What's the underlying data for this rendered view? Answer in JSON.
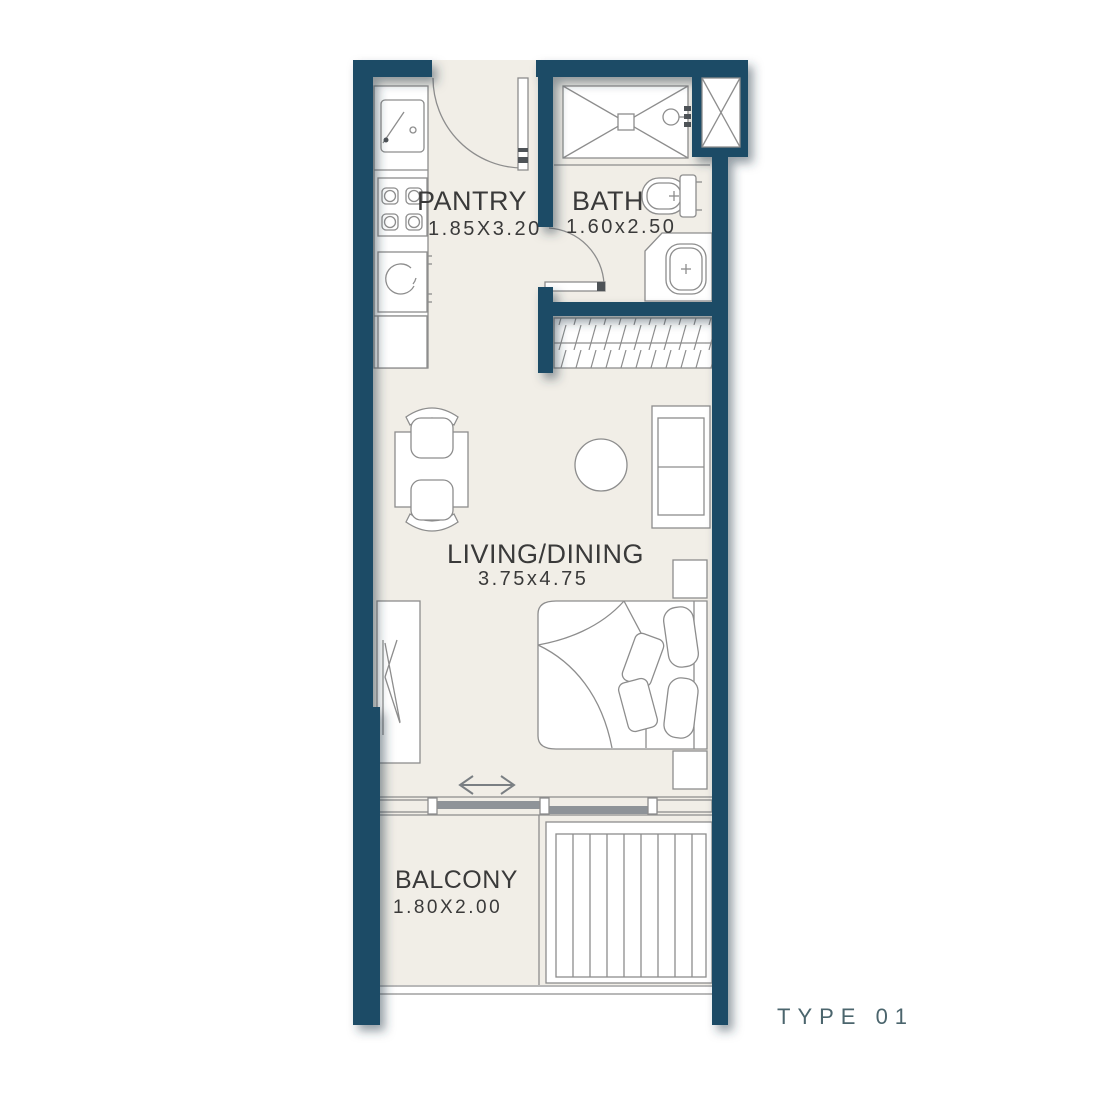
{
  "plan": {
    "title": "TYPE 01",
    "rooms": [
      {
        "id": "pantry",
        "name": "PANTRY",
        "dimensions": "1.85X3.20"
      },
      {
        "id": "bath",
        "name": "BATH",
        "dimensions": "1.60x2.50"
      },
      {
        "id": "living_dining",
        "name": "LIVING/DINING",
        "dimensions": "3.75x4.75"
      },
      {
        "id": "balcony",
        "name": "BALCONY",
        "dimensions": "1.80X2.00"
      }
    ],
    "colors": {
      "wall": "#1d4b66",
      "floor": "#f1eee7",
      "line": "#8d8d8d",
      "label": "#3a3a3a",
      "type_label": "#4b656d",
      "background": "#ffffff"
    },
    "fixtures": [
      "kitchen-counter",
      "kitchen-sink",
      "stove-4-burner",
      "washing-machine",
      "base-cabinet",
      "entry-door",
      "shower",
      "floor-shaft",
      "toilet",
      "vanity-basin",
      "bath-door",
      "closet-hangers",
      "dining-table",
      "dining-chairs",
      "side-table",
      "sofa",
      "wardrobe",
      "bed",
      "pillows",
      "nightstands",
      "sliding-direction-arrow",
      "window-wall",
      "balcony-louver",
      "balcony-railing"
    ]
  }
}
